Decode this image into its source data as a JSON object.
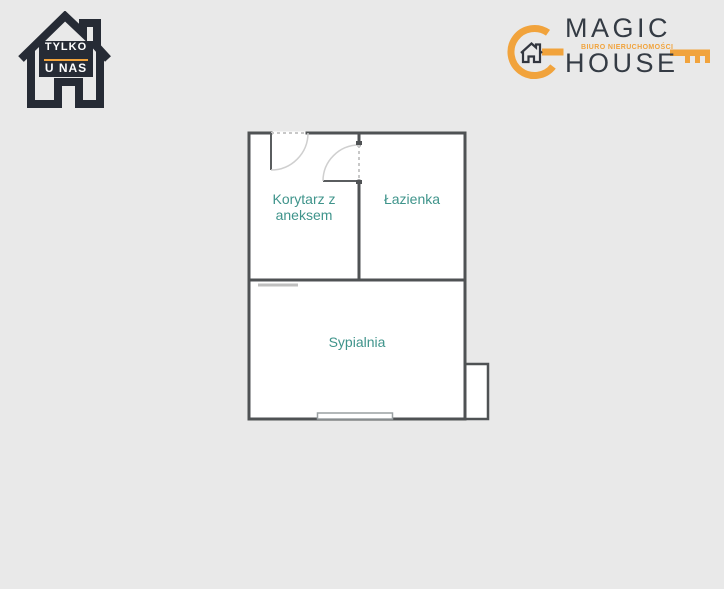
{
  "page": {
    "background_color": "#E9E9E9"
  },
  "badge": {
    "line1": "TYLKO",
    "line2": "U NAS"
  },
  "brand": {
    "name_top": "MAGIC",
    "tagline": "BIURO NIERUCHOMOŚCI",
    "name_bottom": "HOUSE",
    "accent_color": "#F1A33C",
    "text_color": "#343B44"
  },
  "floorplan": {
    "rooms": [
      {
        "name": "Korytarz z aneksem"
      },
      {
        "name": "Łazienka"
      },
      {
        "name": "Sypialnia"
      }
    ],
    "label_color": "#3F948B",
    "wall_color": "#4F5254",
    "background_color": "#FFFFFF"
  }
}
